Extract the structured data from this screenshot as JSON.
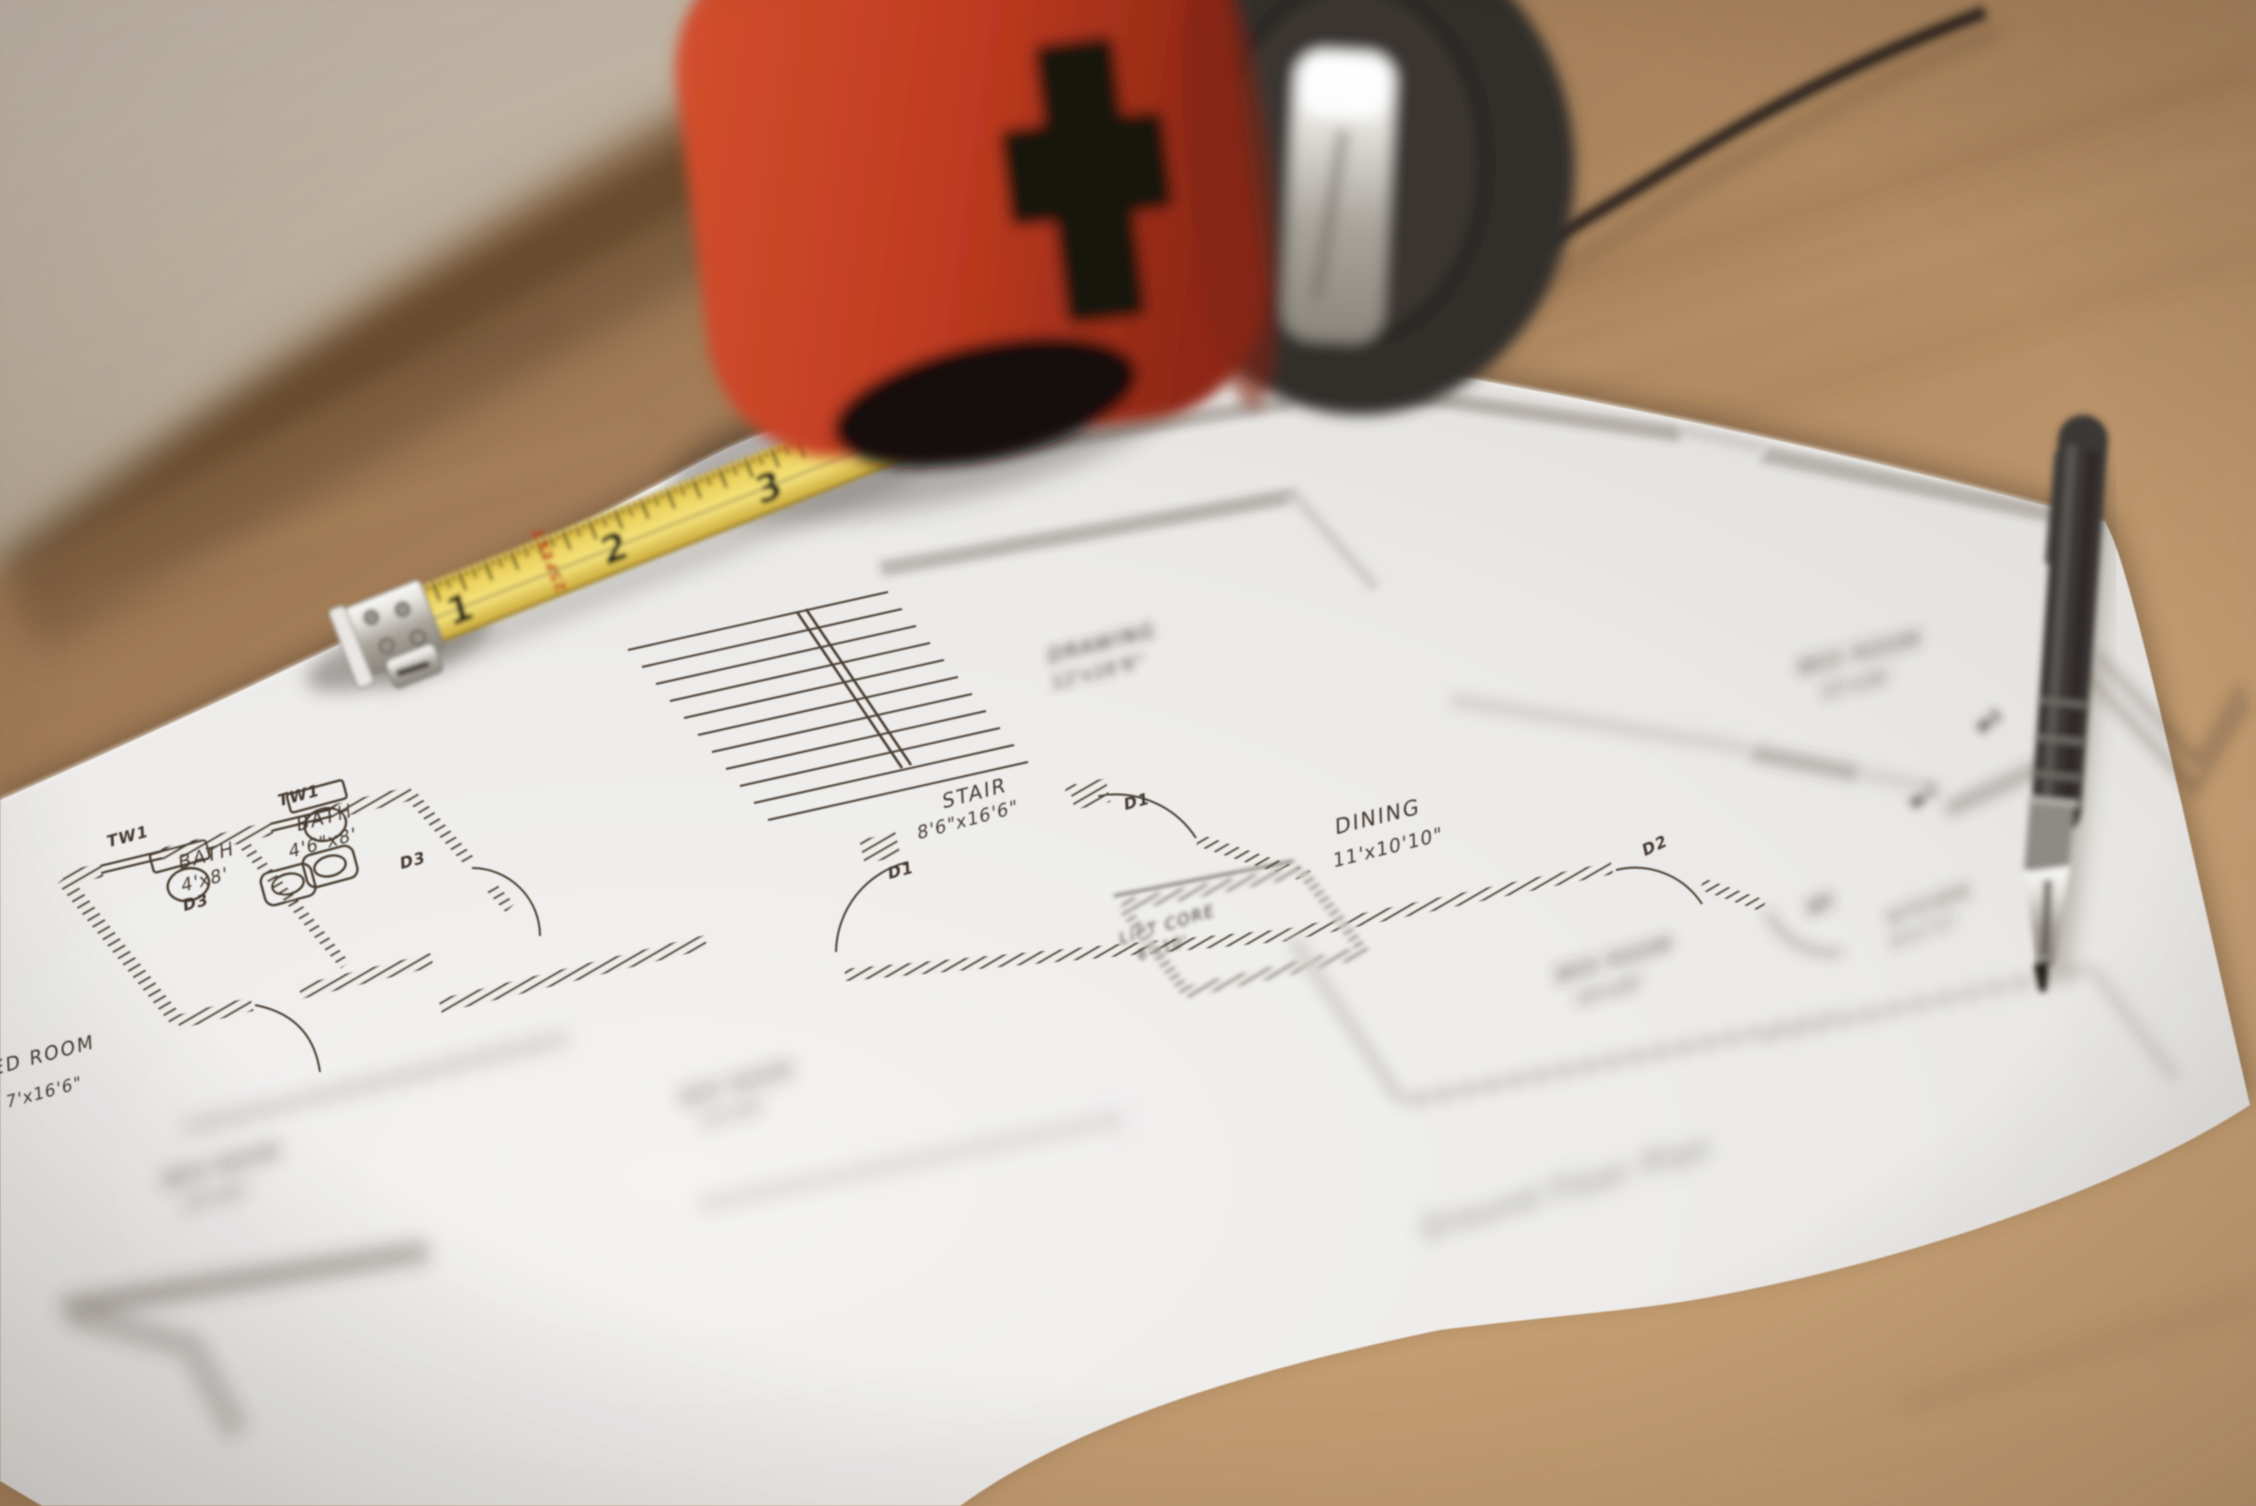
{
  "scene": {
    "description": "Photograph: architectural floor plan sheet on a wooden desk with a red tape measure, extended yellow blade, black pen and a black cord",
    "colors": {
      "wall": "#c7bcae",
      "desk_wood": "#a07a53",
      "paper": "#ecebe9",
      "plan_ink": "#453931",
      "tape_case_red": "#c0432a",
      "tape_blade_yellow": "#ecd25e",
      "tape_feet_red": "#c13a1c",
      "pen_body": "#3b3734",
      "metal": "#c9c6c1"
    }
  },
  "floor_plan": {
    "title": "Ground Floor Plan",
    "rooms": [
      {
        "label": "BATH",
        "dims": "4'x8'"
      },
      {
        "label": "BATH",
        "dims": "4'6\"x8'"
      },
      {
        "label": "STAIR",
        "dims": "8'6\"x16'6\""
      },
      {
        "label": "DINING",
        "dims": "11'x10'10\""
      },
      {
        "label": "LIFT CORE",
        "dims": "6'x10'"
      },
      {
        "label": "DRAWING",
        "dims": "12'x16'6\""
      },
      {
        "label": "BED ROOM",
        "dims": "12'x16'"
      },
      {
        "label": "BED ROOM",
        "dims": "14'x10'"
      },
      {
        "label": "KITCHEN",
        "dims": "8'11\"x7'"
      },
      {
        "label": "BED ROOM",
        "dims": "7'x16'6\""
      },
      {
        "label": "BED ROOM",
        "dims": "12'x12'"
      },
      {
        "label": "BED ROOM",
        "dims": "12'x10'"
      }
    ],
    "labels": {
      "d1": "D1",
      "d2": "D2",
      "d3": "D3",
      "tw1": "TW1",
      "w2": "W2",
      "w3": "W3"
    }
  },
  "tape_measure": {
    "numbers": [
      "1",
      "2",
      "3"
    ],
    "length_text": "25FEET"
  }
}
